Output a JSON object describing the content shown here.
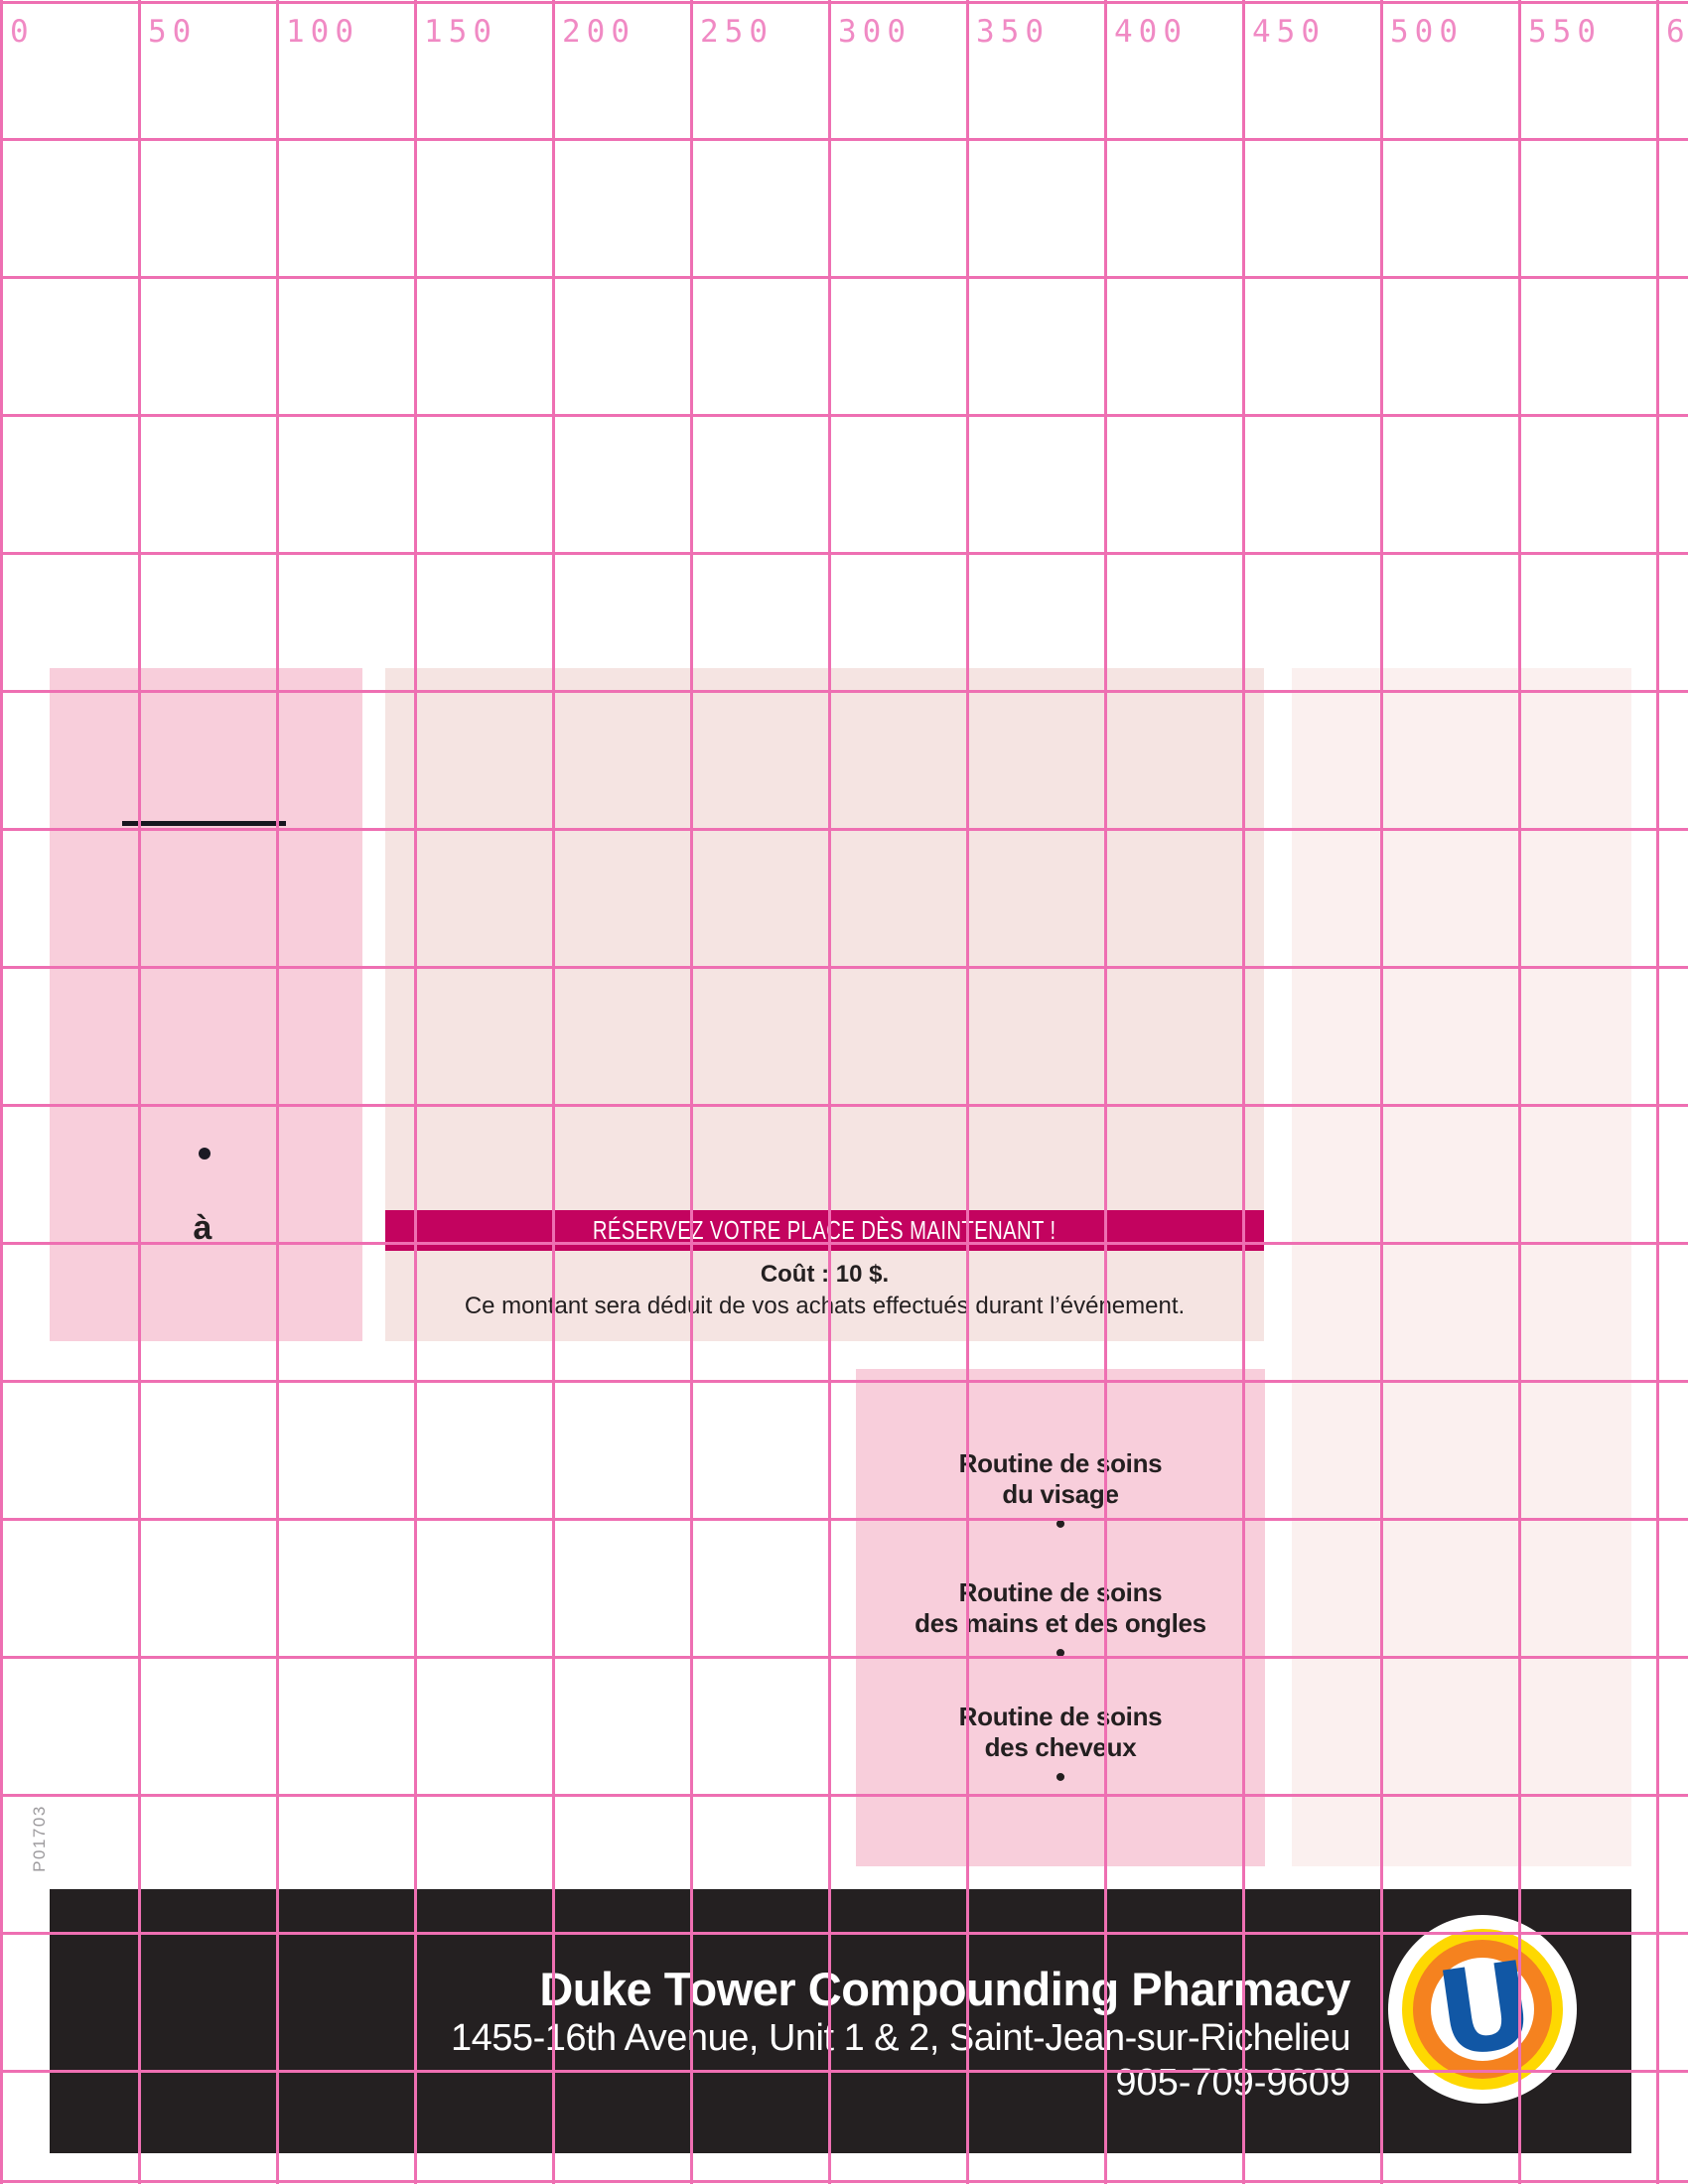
{
  "ruler": {
    "labels": [
      "0",
      "50",
      "100",
      "150",
      "200",
      "250",
      "300",
      "350",
      "400",
      "450",
      "500",
      "550",
      "600"
    ]
  },
  "side_label": "P01703",
  "left_panel": {
    "bullet": "•",
    "word": "à"
  },
  "banner": {
    "label": "RÉSERVEZ VOTRE PLACE DÈS MAINTENANT !"
  },
  "pricing": {
    "cost_line": "Coût : 10 $.",
    "note_line": "Ce montant sera déduit de vos achats effectués durant l’événement."
  },
  "routines": {
    "bullet": "•",
    "items": [
      {
        "line1": "Routine de soins",
        "line2": "du visage"
      },
      {
        "line1": "Routine de soins",
        "line2": "des mains et des ongles"
      },
      {
        "line1": "Routine de soins",
        "line2": "des cheveux"
      }
    ]
  },
  "footer": {
    "name": "Duke Tower Compounding Pharmacy",
    "address": "1455-16th Avenue, Unit 1 & 2, Saint-Jean-sur-Richelieu",
    "phone": "905-709-9609",
    "logo_letter": "U"
  },
  "colors": {
    "grid_line": "#ee6fb2",
    "ruler_text": "#f08ac4",
    "banner_bg": "#c3035f",
    "box_pink": "#f8cedb",
    "box_beige": "#f5e4e2",
    "box_pale": "#fbf0ef",
    "footer_bg": "#242021",
    "text_dark": "#231f20",
    "side_gray": "#9c9a9d",
    "logo_orange": "#f5821f",
    "logo_yellow": "#fed801",
    "logo_blue": "#1157a5"
  }
}
